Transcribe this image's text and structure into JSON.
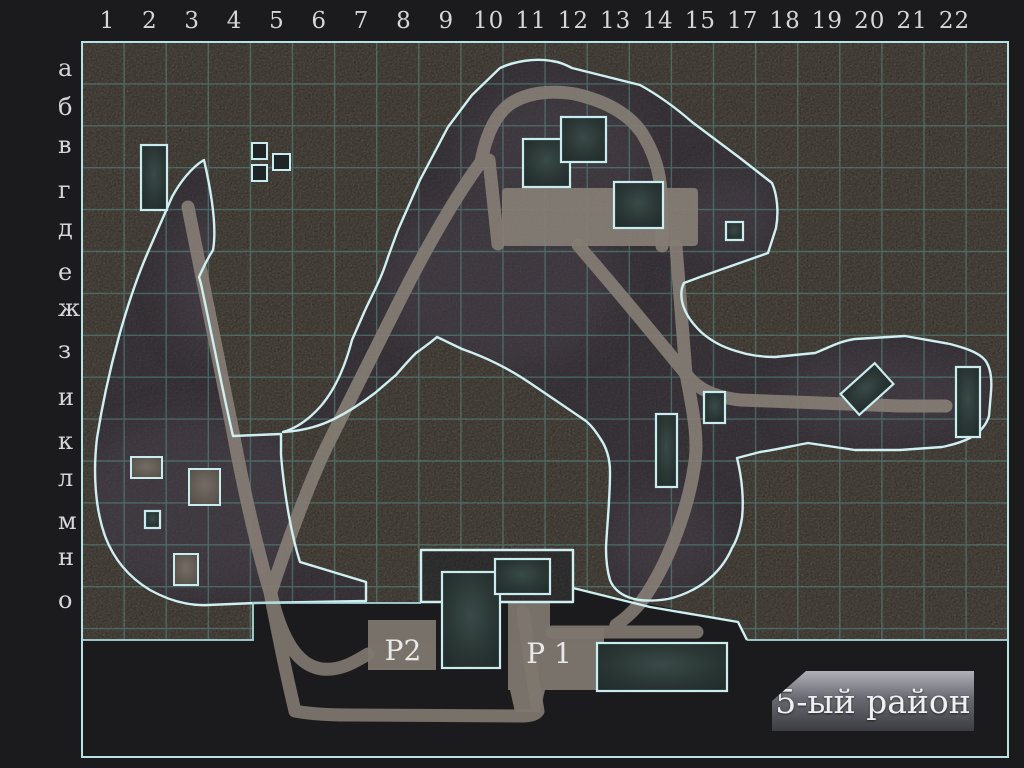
{
  "map": {
    "district_label": "5-ый район",
    "parking_label_p2": "P2",
    "parking_label_p1": "P 1"
  },
  "rulers": {
    "columns": [
      "1",
      "2",
      "3",
      "4",
      "5",
      "6",
      "7",
      "8",
      "9",
      "10",
      "11",
      "12",
      "13",
      "14",
      "15",
      "17",
      "18",
      "19",
      "20",
      "21",
      "22"
    ],
    "rows": [
      "а",
      "б",
      "в",
      "г",
      "д",
      "е",
      "ж",
      "з",
      "и",
      "к",
      "л",
      "м",
      "н",
      "о"
    ]
  },
  "colors": {
    "page_background": "#1b1b1d",
    "grid_line": "#4d8a84",
    "region_outline": "#cfeff1",
    "outer_border": "#b7e2e4",
    "road": "#7e776f",
    "building_fill": "#243130",
    "ruler_text": "#d6d6d6",
    "banner_text": "#eef0f2"
  }
}
